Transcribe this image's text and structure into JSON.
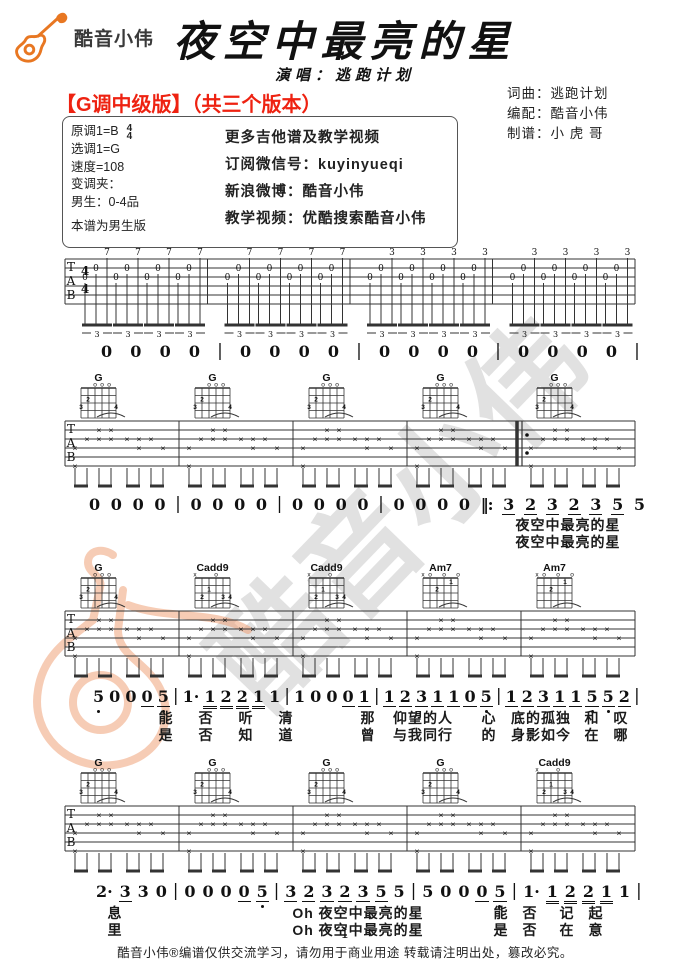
{
  "header": {
    "logo_text": "酷音小伟",
    "title": "夜空中最亮的星",
    "subtitle": "演唱：逃跑计划",
    "credits": [
      "词曲：逃跑计划",
      "编配：酷音小伟",
      "制谱：小 虎 哥"
    ]
  },
  "version_heading": "【G调中级版】（共三个版本）",
  "info_box": {
    "left": [
      "原调1=B",
      "选调1=G",
      "速度=108",
      "变调夹：",
      "男生：0-4品",
      "本谱为男生版"
    ],
    "time_top": "4",
    "time_bottom": "4",
    "right": [
      "更多吉他谱及教学视频",
      "订阅微信号：kuyinyueqi",
      "新浪微博：酷音小伟",
      "教学视频：优酷搜索酷音小伟"
    ]
  },
  "watermark": {
    "text": "酷音小伟"
  },
  "tab_letters": [
    "T",
    "A",
    "B"
  ],
  "time_signature": [
    "4",
    "4"
  ],
  "chord_shapes": {
    "G": {
      "markers": [
        "",
        "",
        "o",
        "o",
        "o",
        ""
      ],
      "dots": [
        {
          "s": 6,
          "f": 3,
          "n": "3"
        },
        {
          "s": 5,
          "f": 2,
          "n": "2"
        },
        {
          "s": 1,
          "f": 3,
          "n": "4"
        }
      ]
    },
    "Cadd9": {
      "markers": [
        "x",
        "",
        "",
        "o",
        "",
        ""
      ],
      "dots": [
        {
          "s": 5,
          "f": 3,
          "n": "2"
        },
        {
          "s": 4,
          "f": 2,
          "n": "1"
        },
        {
          "s": 2,
          "f": 3,
          "n": "3"
        },
        {
          "s": 1,
          "f": 3,
          "n": "4"
        }
      ]
    },
    "Am7": {
      "markers": [
        "x",
        "o",
        "",
        "o",
        "",
        "o"
      ],
      "dots": [
        {
          "s": 4,
          "f": 2,
          "n": "2"
        },
        {
          "s": 2,
          "f": 1,
          "n": "1"
        }
      ]
    }
  },
  "systems": [
    {
      "kind": "triplet",
      "tops": [
        "7",
        "7",
        "7",
        "7",
        "7",
        "7",
        "7",
        "7",
        "3",
        "3",
        "3",
        "3",
        "3",
        "3",
        "3",
        "3"
      ],
      "triplet_label": "3"
    },
    {
      "kind": "strum",
      "chords": [
        "G",
        "G",
        "G",
        "G",
        "G"
      ],
      "repeat_before": 4
    },
    {
      "kind": "strum",
      "chords": [
        "G",
        "Cadd9",
        "Cadd9",
        "Am7",
        "Am7"
      ]
    },
    {
      "kind": "strum",
      "chords": [
        "G",
        "G",
        "G",
        "G",
        "Cadd9"
      ]
    }
  ],
  "number_rows": [
    {
      "id": "rowA",
      "tokens": [
        {
          "t": "0"
        },
        {
          "t": "0"
        },
        {
          "t": "0"
        },
        {
          "t": "0"
        },
        {
          "t": "|"
        },
        {
          "t": "0"
        },
        {
          "t": "0"
        },
        {
          "t": "0"
        },
        {
          "t": "0"
        },
        {
          "t": "|"
        },
        {
          "t": "0"
        },
        {
          "t": "0"
        },
        {
          "t": "0"
        },
        {
          "t": "0"
        },
        {
          "t": "|"
        },
        {
          "t": "0"
        },
        {
          "t": "0"
        },
        {
          "t": "0"
        },
        {
          "t": "0"
        },
        {
          "t": "|"
        }
      ]
    },
    {
      "id": "rowB",
      "tokens": [
        {
          "t": "0"
        },
        {
          "t": "0"
        },
        {
          "t": "0"
        },
        {
          "t": "0"
        },
        {
          "t": "|"
        },
        {
          "t": "0"
        },
        {
          "t": "0"
        },
        {
          "t": "0"
        },
        {
          "t": "0"
        },
        {
          "t": "|"
        },
        {
          "t": "0"
        },
        {
          "t": "0"
        },
        {
          "t": "0"
        },
        {
          "t": "0"
        },
        {
          "t": "|"
        },
        {
          "t": "0"
        },
        {
          "t": "0"
        },
        {
          "t": "0"
        },
        {
          "t": "0"
        },
        {
          "t": "‖:",
          "rep": 1
        },
        {
          "t": "3",
          "u": 1
        },
        {
          "t": "2",
          "u": 1
        },
        {
          "t": "3",
          "u": 1
        },
        {
          "t": "2",
          "u": 1
        },
        {
          "t": "3",
          "u": 1
        },
        {
          "t": "5",
          "u": 1
        },
        {
          "t": "5"
        }
      ]
    },
    {
      "id": "rowC",
      "tokens": [
        {
          "t": "5",
          "d": 1
        },
        {
          "t": "0"
        },
        {
          "t": "0"
        },
        {
          "t": "0",
          "u": 1
        },
        {
          "t": "5",
          "u": 1,
          "d": 1
        },
        {
          "t": "|"
        },
        {
          "t": "1·"
        },
        {
          "t": "1",
          "u": 2
        },
        {
          "t": "2",
          "u": 2
        },
        {
          "t": "2",
          "u": 2
        },
        {
          "t": "1",
          "u": 2
        },
        {
          "t": "1"
        },
        {
          "t": "|"
        },
        {
          "t": "1"
        },
        {
          "t": "0"
        },
        {
          "t": "0"
        },
        {
          "t": "0",
          "u": 1
        },
        {
          "t": "1",
          "u": 1
        },
        {
          "t": "|"
        },
        {
          "t": "1",
          "u": 1
        },
        {
          "t": "2",
          "u": 1
        },
        {
          "t": "3",
          "u": 1
        },
        {
          "t": "1",
          "u": 1
        },
        {
          "t": "1",
          "u": 1
        },
        {
          "t": "0",
          "u": 1
        },
        {
          "t": "5",
          "u": 1,
          "d": 1
        },
        {
          "t": "|"
        },
        {
          "t": "1",
          "u": 1
        },
        {
          "t": "2",
          "u": 1
        },
        {
          "t": "3",
          "u": 1
        },
        {
          "t": "1",
          "u": 1
        },
        {
          "t": "1",
          "u": 1
        },
        {
          "t": "5",
          "u": 1,
          "d": 1
        },
        {
          "t": "5",
          "u": 1,
          "d": 1
        },
        {
          "t": "2",
          "u": 1
        },
        {
          "t": "|"
        }
      ]
    },
    {
      "id": "rowD",
      "tokens": [
        {
          "t": "2·"
        },
        {
          "t": "3",
          "u": 1
        },
        {
          "t": "3"
        },
        {
          "t": "0"
        },
        {
          "t": "|"
        },
        {
          "t": "0"
        },
        {
          "t": "0"
        },
        {
          "t": "0"
        },
        {
          "t": "0",
          "u": 1
        },
        {
          "t": "5",
          "u": 1,
          "d": 1
        },
        {
          "t": "|"
        },
        {
          "t": "3",
          "u": 1
        },
        {
          "t": "2",
          "u": 1
        },
        {
          "t": "3",
          "u": 1
        },
        {
          "t": "2",
          "u": 1
        },
        {
          "t": "3",
          "u": 1
        },
        {
          "t": "5",
          "u": 1
        },
        {
          "t": "5"
        },
        {
          "t": "|"
        },
        {
          "t": "5"
        },
        {
          "t": "0"
        },
        {
          "t": "0"
        },
        {
          "t": "0",
          "u": 1
        },
        {
          "t": "5",
          "u": 1,
          "d": 1
        },
        {
          "t": "|"
        },
        {
          "t": "1·"
        },
        {
          "t": "1",
          "u": 2
        },
        {
          "t": "2",
          "u": 2
        },
        {
          "t": "2",
          "u": 2
        },
        {
          "t": "1",
          "u": 2
        },
        {
          "t": "1"
        },
        {
          "t": "|"
        }
      ]
    }
  ],
  "lyric_blocks": [
    {
      "name": "verse-entry",
      "lines": [
        {
          "y": 515,
          "segs": [
            {
              "x": 568,
              "t": "夜空中最亮的星"
            }
          ]
        },
        {
          "y": 532,
          "segs": [
            {
              "x": 568,
              "t": "夜空中最亮的星"
            }
          ]
        }
      ]
    },
    {
      "name": "verse-1",
      "lines": [
        {
          "y": 708,
          "segs": [
            {
              "x": 166,
              "t": "能"
            },
            {
              "x": 206,
              "t": "否"
            },
            {
              "x": 246,
              "t": "听"
            },
            {
              "x": 286,
              "t": "清"
            },
            {
              "x": 368,
              "t": "那"
            },
            {
              "x": 423,
              "t": "仰望的人"
            },
            {
              "x": 489,
              "t": "心"
            },
            {
              "x": 541,
              "t": "底的孤独"
            },
            {
              "x": 592,
              "t": "和"
            },
            {
              "x": 621,
              "t": "叹"
            }
          ]
        },
        {
          "y": 725,
          "segs": [
            {
              "x": 166,
              "t": "是"
            },
            {
              "x": 206,
              "t": "否"
            },
            {
              "x": 246,
              "t": "知"
            },
            {
              "x": 286,
              "t": "道"
            },
            {
              "x": 368,
              "t": "曾"
            },
            {
              "x": 423,
              "t": "与我同行"
            },
            {
              "x": 489,
              "t": "的"
            },
            {
              "x": 541,
              "t": "身影如今"
            },
            {
              "x": 592,
              "t": "在"
            },
            {
              "x": 621,
              "t": "哪"
            }
          ]
        }
      ]
    },
    {
      "name": "chorus",
      "lines": [
        {
          "y": 903,
          "segs": [
            {
              "x": 115,
              "t": "息"
            },
            {
              "x": 358,
              "t": "Oh 夜空中最亮的星"
            },
            {
              "x": 501,
              "t": "能"
            },
            {
              "x": 530,
              "t": "否"
            },
            {
              "x": 567,
              "t": "记"
            },
            {
              "x": 596,
              "t": "起"
            }
          ]
        },
        {
          "y": 920,
          "segs": [
            {
              "x": 115,
              "t": "里"
            },
            {
              "x": 358,
              "t": "Oh 夜空中最亮的星"
            },
            {
              "x": 501,
              "t": "是"
            },
            {
              "x": 530,
              "t": "否"
            },
            {
              "x": 567,
              "t": "在"
            },
            {
              "x": 596,
              "t": "意"
            }
          ]
        }
      ]
    }
  ],
  "footer": {
    "page_number": "1",
    "disclaimer": "酷音小伟®编谱仅供交流学习，请勿用于商业用途 转载请注明出处，篡改必究。"
  }
}
